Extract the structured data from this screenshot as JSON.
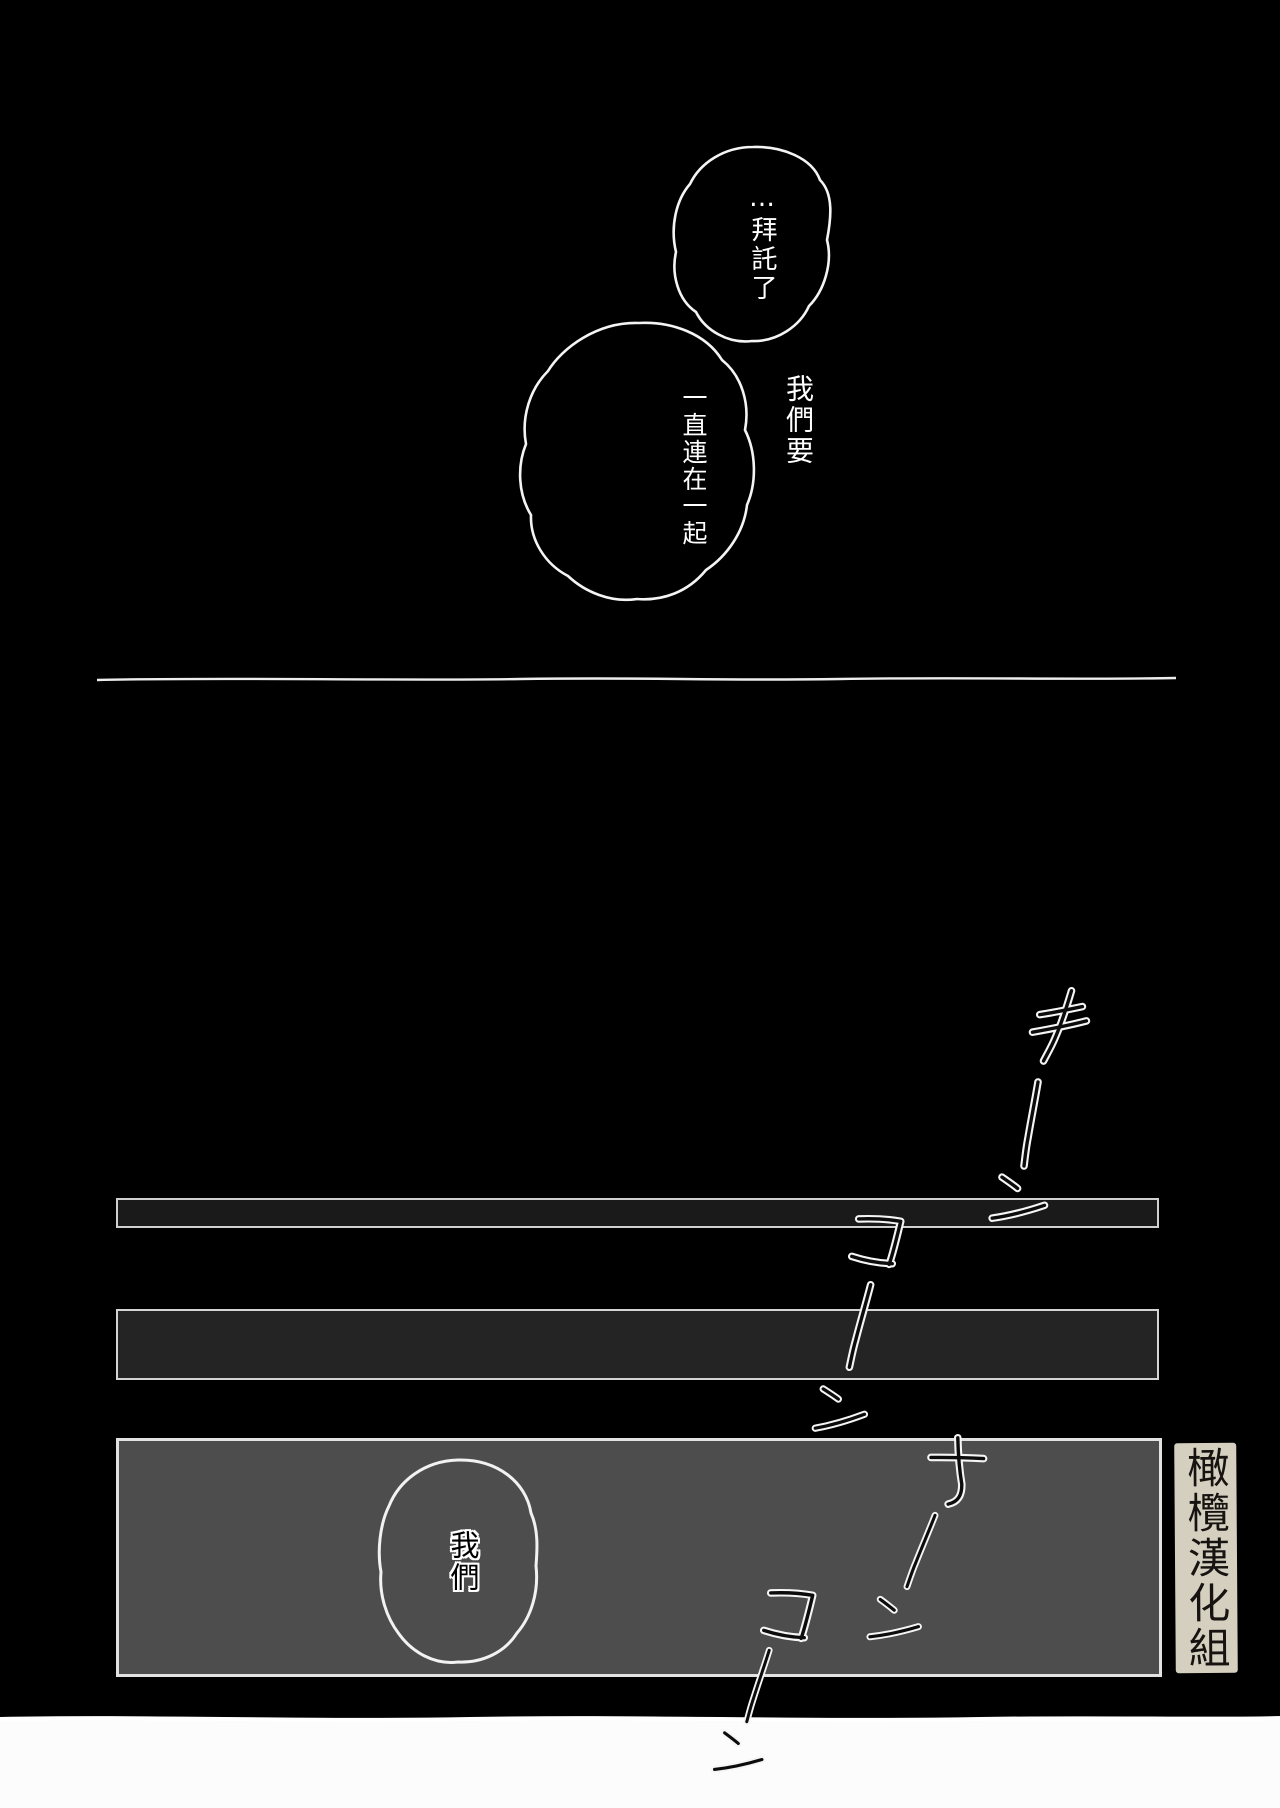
{
  "speech": {
    "bubble_top": {
      "text": "…拜託了"
    },
    "bubble_main": {
      "lines": [
        "我們要",
        "一直連在一起"
      ]
    },
    "bubble_panel": {
      "text": "我們"
    }
  },
  "sfx": {
    "text": "キーンコーンカーンコーン"
  },
  "credit": {
    "text": "橄欖漢化組"
  },
  "colors": {
    "background": "#000000",
    "bar1_fill": "#1a1a1a",
    "bar2_fill": "#242424",
    "panel_fill": "#4d4d4d",
    "panel_border": "#e2e2e2",
    "credit_bg": "#d5cfc0",
    "divider_line": "#ededed",
    "bottom_margin": "#fcfcfc",
    "bubble_stroke": "#f4f4f4",
    "bubble_fill": "#000000",
    "sfx_ink": "#0c0c0c",
    "sfx_halo": "#f5f5f5"
  }
}
